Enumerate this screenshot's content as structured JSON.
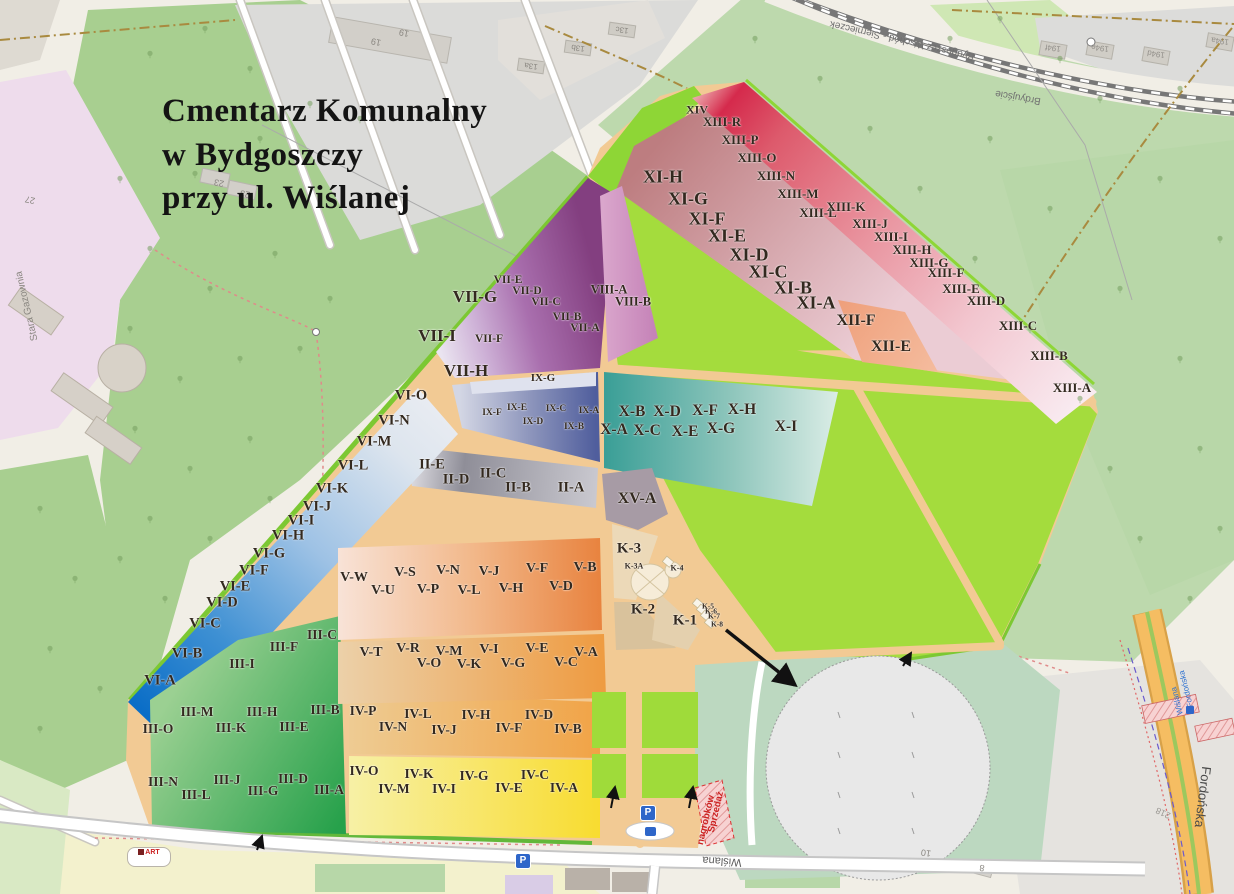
{
  "title": {
    "line1": "Cmentarz Komunalny",
    "line2": "w Bydgoszczy",
    "line3": "przy ul. Wiślanej"
  },
  "icons": {
    "parking_label": "P",
    "shop_label": "ART"
  },
  "colors": {
    "background": "#f1eee6",
    "forest": "#a8cf90",
    "bright_green": "#a4dc3d",
    "path_tan": "#f2ca94",
    "section_red": "#d52a4c",
    "section_blue": "#0b6ec7",
    "section_purple": "#833f80",
    "section_teal": "#3b9f97",
    "section_yellow": "#f8dc30",
    "section_green": "#27a14b",
    "road_orange": "#f5bd62",
    "accent_blue": "#2e66c9",
    "warning_red": "#cc2222"
  },
  "sections": [
    {
      "label": "XIV",
      "x": 697,
      "y": 110,
      "fs": 12
    },
    {
      "label": "XIII-R",
      "x": 722,
      "y": 122,
      "fs": 13
    },
    {
      "label": "XIII-P",
      "x": 740,
      "y": 140,
      "fs": 13
    },
    {
      "label": "XIII-O",
      "x": 757,
      "y": 158,
      "fs": 13
    },
    {
      "label": "XIII-N",
      "x": 776,
      "y": 176,
      "fs": 13
    },
    {
      "label": "XIII-M",
      "x": 798,
      "y": 194,
      "fs": 13
    },
    {
      "label": "XIII-L",
      "x": 818,
      "y": 213,
      "fs": 13
    },
    {
      "label": "XIII-K",
      "x": 846,
      "y": 207,
      "fs": 13
    },
    {
      "label": "XIII-J",
      "x": 870,
      "y": 224,
      "fs": 13
    },
    {
      "label": "XIII-I",
      "x": 891,
      "y": 237,
      "fs": 13
    },
    {
      "label": "XIII-H",
      "x": 912,
      "y": 250,
      "fs": 13
    },
    {
      "label": "XIII-G",
      "x": 929,
      "y": 263,
      "fs": 13
    },
    {
      "label": "XIII-F",
      "x": 946,
      "y": 273,
      "fs": 13
    },
    {
      "label": "XIII-E",
      "x": 961,
      "y": 289,
      "fs": 13
    },
    {
      "label": "XIII-D",
      "x": 986,
      "y": 301,
      "fs": 13
    },
    {
      "label": "XIII-C",
      "x": 1018,
      "y": 326,
      "fs": 13
    },
    {
      "label": "XIII-B",
      "x": 1049,
      "y": 356,
      "fs": 13
    },
    {
      "label": "XIII-A",
      "x": 1072,
      "y": 388,
      "fs": 13
    },
    {
      "label": "XI-H",
      "x": 663,
      "y": 177,
      "fs": 18
    },
    {
      "label": "XI-G",
      "x": 688,
      "y": 199,
      "fs": 18
    },
    {
      "label": "XI-F",
      "x": 707,
      "y": 219,
      "fs": 18
    },
    {
      "label": "XI-E",
      "x": 727,
      "y": 236,
      "fs": 18
    },
    {
      "label": "XI-D",
      "x": 749,
      "y": 255,
      "fs": 18
    },
    {
      "label": "XI-C",
      "x": 768,
      "y": 272,
      "fs": 18
    },
    {
      "label": "XI-B",
      "x": 793,
      "y": 288,
      "fs": 18
    },
    {
      "label": "XI-A",
      "x": 816,
      "y": 303,
      "fs": 18
    },
    {
      "label": "XII-F",
      "x": 856,
      "y": 321,
      "fs": 16
    },
    {
      "label": "XII-E",
      "x": 891,
      "y": 347,
      "fs": 16
    },
    {
      "label": "VII-G",
      "x": 475,
      "y": 297,
      "fs": 17
    },
    {
      "label": "VII-E",
      "x": 508,
      "y": 280,
      "fs": 11.5
    },
    {
      "label": "VII-D",
      "x": 527,
      "y": 291,
      "fs": 11.5
    },
    {
      "label": "VII-C",
      "x": 546,
      "y": 302,
      "fs": 11.5
    },
    {
      "label": "VII-B",
      "x": 567,
      "y": 317,
      "fs": 11.5
    },
    {
      "label": "VII-A",
      "x": 585,
      "y": 328,
      "fs": 11.5
    },
    {
      "label": "VII-F",
      "x": 489,
      "y": 339,
      "fs": 11.5
    },
    {
      "label": "VII-I",
      "x": 437,
      "y": 336,
      "fs": 17
    },
    {
      "label": "VII-H",
      "x": 466,
      "y": 371,
      "fs": 17
    },
    {
      "label": "VIII-A",
      "x": 609,
      "y": 290,
      "fs": 12.5
    },
    {
      "label": "VIII-B",
      "x": 633,
      "y": 302,
      "fs": 12.5
    },
    {
      "label": "IX-G",
      "x": 543,
      "y": 378,
      "fs": 11
    },
    {
      "label": "IX-F",
      "x": 492,
      "y": 413,
      "fs": 9.5
    },
    {
      "label": "IX-E",
      "x": 517,
      "y": 408,
      "fs": 9.5
    },
    {
      "label": "IX-D",
      "x": 533,
      "y": 422,
      "fs": 9.5
    },
    {
      "label": "IX-C",
      "x": 556,
      "y": 409,
      "fs": 9.5
    },
    {
      "label": "IX-B",
      "x": 574,
      "y": 427,
      "fs": 9.5
    },
    {
      "label": "IX-A",
      "x": 589,
      "y": 411,
      "fs": 9.5
    },
    {
      "label": "X-B",
      "x": 632,
      "y": 412,
      "fs": 15.5
    },
    {
      "label": "X-D",
      "x": 667,
      "y": 412,
      "fs": 15.5
    },
    {
      "label": "X-F",
      "x": 705,
      "y": 411,
      "fs": 15.5
    },
    {
      "label": "X-H",
      "x": 742,
      "y": 410,
      "fs": 15.5
    },
    {
      "label": "X-A",
      "x": 614,
      "y": 430,
      "fs": 15.5
    },
    {
      "label": "X-C",
      "x": 647,
      "y": 431,
      "fs": 15.5
    },
    {
      "label": "X-E",
      "x": 685,
      "y": 432,
      "fs": 15.5
    },
    {
      "label": "X-G",
      "x": 721,
      "y": 429,
      "fs": 15.5
    },
    {
      "label": "X-I",
      "x": 786,
      "y": 427,
      "fs": 15.5
    },
    {
      "label": "II-E",
      "x": 432,
      "y": 465,
      "fs": 14.5
    },
    {
      "label": "II-D",
      "x": 456,
      "y": 480,
      "fs": 14.5
    },
    {
      "label": "II-C",
      "x": 493,
      "y": 474,
      "fs": 14.5
    },
    {
      "label": "II-B",
      "x": 518,
      "y": 488,
      "fs": 14.5
    },
    {
      "label": "II-A",
      "x": 571,
      "y": 488,
      "fs": 14.5
    },
    {
      "label": "XV-A",
      "x": 637,
      "y": 499,
      "fs": 16
    },
    {
      "label": "VI-O",
      "x": 411,
      "y": 396,
      "fs": 14.5
    },
    {
      "label": "VI-N",
      "x": 394,
      "y": 421,
      "fs": 14.5
    },
    {
      "label": "VI-M",
      "x": 374,
      "y": 442,
      "fs": 14.5
    },
    {
      "label": "VI-L",
      "x": 353,
      "y": 466,
      "fs": 14.5
    },
    {
      "label": "VI-K",
      "x": 332,
      "y": 489,
      "fs": 14.5
    },
    {
      "label": "VI-J",
      "x": 317,
      "y": 507,
      "fs": 14.5
    },
    {
      "label": "VI-I",
      "x": 301,
      "y": 521,
      "fs": 14.5
    },
    {
      "label": "VI-H",
      "x": 288,
      "y": 536,
      "fs": 14.5
    },
    {
      "label": "VI-G",
      "x": 269,
      "y": 554,
      "fs": 14.5
    },
    {
      "label": "VI-F",
      "x": 254,
      "y": 571,
      "fs": 14.5
    },
    {
      "label": "VI-E",
      "x": 235,
      "y": 587,
      "fs": 14.5
    },
    {
      "label": "VI-D",
      "x": 222,
      "y": 603,
      "fs": 14.5
    },
    {
      "label": "VI-C",
      "x": 205,
      "y": 624,
      "fs": 14.5
    },
    {
      "label": "VI-B",
      "x": 187,
      "y": 654,
      "fs": 14.5
    },
    {
      "label": "VI-A",
      "x": 160,
      "y": 681,
      "fs": 14.5
    },
    {
      "label": "III-C",
      "x": 322,
      "y": 635,
      "fs": 13.5
    },
    {
      "label": "III-F",
      "x": 284,
      "y": 647,
      "fs": 13.5
    },
    {
      "label": "III-I",
      "x": 242,
      "y": 664,
      "fs": 13.5
    },
    {
      "label": "III-M",
      "x": 197,
      "y": 712,
      "fs": 13.5
    },
    {
      "label": "III-H",
      "x": 262,
      "y": 712,
      "fs": 13.5
    },
    {
      "label": "III-B",
      "x": 325,
      "y": 710,
      "fs": 13.5
    },
    {
      "label": "III-O",
      "x": 158,
      "y": 729,
      "fs": 13.5
    },
    {
      "label": "III-K",
      "x": 231,
      "y": 728,
      "fs": 13.5
    },
    {
      "label": "III-E",
      "x": 294,
      "y": 727,
      "fs": 13.5
    },
    {
      "label": "III-N",
      "x": 163,
      "y": 782,
      "fs": 13.5
    },
    {
      "label": "III-J",
      "x": 227,
      "y": 780,
      "fs": 13.5
    },
    {
      "label": "III-D",
      "x": 293,
      "y": 779,
      "fs": 13.5
    },
    {
      "label": "III-L",
      "x": 196,
      "y": 795,
      "fs": 13.5
    },
    {
      "label": "III-G",
      "x": 263,
      "y": 791,
      "fs": 13.5
    },
    {
      "label": "III-A",
      "x": 329,
      "y": 790,
      "fs": 13.5
    },
    {
      "label": "IV-P",
      "x": 363,
      "y": 711,
      "fs": 13.5
    },
    {
      "label": "IV-L",
      "x": 418,
      "y": 714,
      "fs": 13.5
    },
    {
      "label": "IV-H",
      "x": 476,
      "y": 715,
      "fs": 13.5
    },
    {
      "label": "IV-D",
      "x": 539,
      "y": 715,
      "fs": 13.5
    },
    {
      "label": "IV-N",
      "x": 393,
      "y": 727,
      "fs": 13.5
    },
    {
      "label": "IV-J",
      "x": 444,
      "y": 730,
      "fs": 13.5
    },
    {
      "label": "IV-F",
      "x": 509,
      "y": 728,
      "fs": 13.5
    },
    {
      "label": "IV-B",
      "x": 568,
      "y": 729,
      "fs": 13.5
    },
    {
      "label": "IV-O",
      "x": 364,
      "y": 771,
      "fs": 13.5
    },
    {
      "label": "IV-K",
      "x": 419,
      "y": 774,
      "fs": 13.5
    },
    {
      "label": "IV-G",
      "x": 474,
      "y": 776,
      "fs": 13.5
    },
    {
      "label": "IV-C",
      "x": 535,
      "y": 775,
      "fs": 13.5
    },
    {
      "label": "IV-M",
      "x": 394,
      "y": 789,
      "fs": 13.5
    },
    {
      "label": "IV-I",
      "x": 444,
      "y": 789,
      "fs": 13.5
    },
    {
      "label": "IV-E",
      "x": 509,
      "y": 788,
      "fs": 13.5
    },
    {
      "label": "IV-A",
      "x": 564,
      "y": 788,
      "fs": 13.5
    },
    {
      "label": "V-W",
      "x": 354,
      "y": 578,
      "fs": 14
    },
    {
      "label": "V-S",
      "x": 405,
      "y": 573,
      "fs": 14
    },
    {
      "label": "V-N",
      "x": 448,
      "y": 571,
      "fs": 14
    },
    {
      "label": "V-J",
      "x": 489,
      "y": 572,
      "fs": 14
    },
    {
      "label": "V-F",
      "x": 537,
      "y": 569,
      "fs": 14
    },
    {
      "label": "V-B",
      "x": 585,
      "y": 568,
      "fs": 14
    },
    {
      "label": "V-U",
      "x": 383,
      "y": 591,
      "fs": 14
    },
    {
      "label": "V-P",
      "x": 428,
      "y": 590,
      "fs": 14
    },
    {
      "label": "V-L",
      "x": 469,
      "y": 591,
      "fs": 14
    },
    {
      "label": "V-H",
      "x": 511,
      "y": 589,
      "fs": 14
    },
    {
      "label": "V-D",
      "x": 561,
      "y": 587,
      "fs": 14
    },
    {
      "label": "V-T",
      "x": 371,
      "y": 653,
      "fs": 14
    },
    {
      "label": "V-R",
      "x": 408,
      "y": 649,
      "fs": 14
    },
    {
      "label": "V-M",
      "x": 449,
      "y": 652,
      "fs": 14
    },
    {
      "label": "V-I",
      "x": 489,
      "y": 650,
      "fs": 14
    },
    {
      "label": "V-E",
      "x": 537,
      "y": 649,
      "fs": 14
    },
    {
      "label": "V-A",
      "x": 586,
      "y": 653,
      "fs": 14
    },
    {
      "label": "V-O",
      "x": 429,
      "y": 664,
      "fs": 14
    },
    {
      "label": "V-K",
      "x": 469,
      "y": 665,
      "fs": 14
    },
    {
      "label": "V-G",
      "x": 513,
      "y": 664,
      "fs": 14
    },
    {
      "label": "V-C",
      "x": 566,
      "y": 663,
      "fs": 14
    },
    {
      "label": "K-3",
      "x": 629,
      "y": 549,
      "fs": 15
    },
    {
      "label": "K-3A",
      "x": 634,
      "y": 566,
      "fs": 8
    },
    {
      "label": "K-4",
      "x": 677,
      "y": 568,
      "fs": 8
    },
    {
      "label": "K-2",
      "x": 643,
      "y": 610,
      "fs": 15
    },
    {
      "label": "K-1",
      "x": 685,
      "y": 621,
      "fs": 15
    },
    {
      "label": "K-5",
      "x": 708,
      "y": 606,
      "fs": 7.5
    },
    {
      "label": "K-6",
      "x": 711,
      "y": 611,
      "fs": 7.5
    },
    {
      "label": "K-7",
      "x": 714,
      "y": 616,
      "fs": 7.5
    },
    {
      "label": "K-8",
      "x": 717,
      "y": 624,
      "fs": 7.5
    }
  ],
  "map_texts": [
    {
      "text": "Bydgoszcz Wschód - Siernieczek",
      "x": 902,
      "y": 40,
      "rot": 193,
      "size": 10,
      "color": "#707070"
    },
    {
      "text": "Brdyujście",
      "x": 1018,
      "y": 97,
      "rot": 190,
      "size": 10,
      "color": "#707070"
    },
    {
      "text": "194f",
      "x": 1053,
      "y": 48,
      "rot": 188,
      "size": 8,
      "color": "#928f8a"
    },
    {
      "text": "194e",
      "x": 1100,
      "y": 48,
      "rot": 188,
      "size": 8,
      "color": "#928f8a"
    },
    {
      "text": "194d",
      "x": 1156,
      "y": 54,
      "rot": 188,
      "size": 8,
      "color": "#928f8a"
    },
    {
      "text": "194a",
      "x": 1220,
      "y": 41,
      "rot": 188,
      "size": 8,
      "color": "#928f8a"
    },
    {
      "text": "23",
      "x": 219,
      "y": 183,
      "rot": 192,
      "size": 9,
      "color": "#8a8781"
    },
    {
      "text": "23",
      "x": 245,
      "y": 194,
      "rot": 192,
      "size": 9,
      "color": "#8a8781"
    },
    {
      "text": "19",
      "x": 376,
      "y": 42,
      "rot": 192,
      "size": 9,
      "color": "#8a8781"
    },
    {
      "text": "19",
      "x": 404,
      "y": 33,
      "rot": 192,
      "size": 9,
      "color": "#8a8781"
    },
    {
      "text": "13a",
      "x": 531,
      "y": 66,
      "rot": 188,
      "size": 8,
      "color": "#8a8781"
    },
    {
      "text": "13b",
      "x": 578,
      "y": 48,
      "rot": 188,
      "size": 8,
      "color": "#8a8781"
    },
    {
      "text": "13c",
      "x": 622,
      "y": 30,
      "rot": 188,
      "size": 8,
      "color": "#8a8781"
    },
    {
      "text": "27",
      "x": 30,
      "y": 200,
      "rot": 192,
      "size": 9,
      "color": "#8a8781"
    },
    {
      "text": "Stara Gazownia",
      "x": 27,
      "y": 306,
      "rot": 257,
      "size": 10,
      "color": "#8a8781"
    },
    {
      "text": "Wiślana",
      "x": 722,
      "y": 861,
      "rot": 184,
      "size": 11,
      "color": "#5a5a5a"
    },
    {
      "text": "Fordońska",
      "x": 1203,
      "y": 797,
      "rot": 97,
      "size": 13,
      "color": "#4a4a4a"
    },
    {
      "text": "218",
      "x": 1163,
      "y": 813,
      "rot": 205,
      "size": 9,
      "color": "#9a9792"
    },
    {
      "text": "10",
      "x": 926,
      "y": 853,
      "rot": 188,
      "size": 9,
      "color": "#8a8781"
    },
    {
      "text": "8",
      "x": 982,
      "y": 868,
      "rot": 188,
      "size": 9,
      "color": "#8a8781"
    },
    {
      "text": "Fordońska",
      "x": 1186,
      "y": 689,
      "rot": 256,
      "size": 8,
      "color": "#2a6fd0"
    },
    {
      "text": "Wiślana",
      "x": 1177,
      "y": 701,
      "rot": 256,
      "size": 8,
      "color": "#2a6fd0"
    },
    {
      "text": "Sprzedaż",
      "x": 716,
      "y": 812,
      "rot": 283,
      "size": 9.5,
      "color": "#cc2222",
      "bold": true
    },
    {
      "text": "nagrobków",
      "x": 706,
      "y": 820,
      "rot": 283,
      "size": 9.5,
      "color": "#cc2222",
      "bold": true
    }
  ]
}
